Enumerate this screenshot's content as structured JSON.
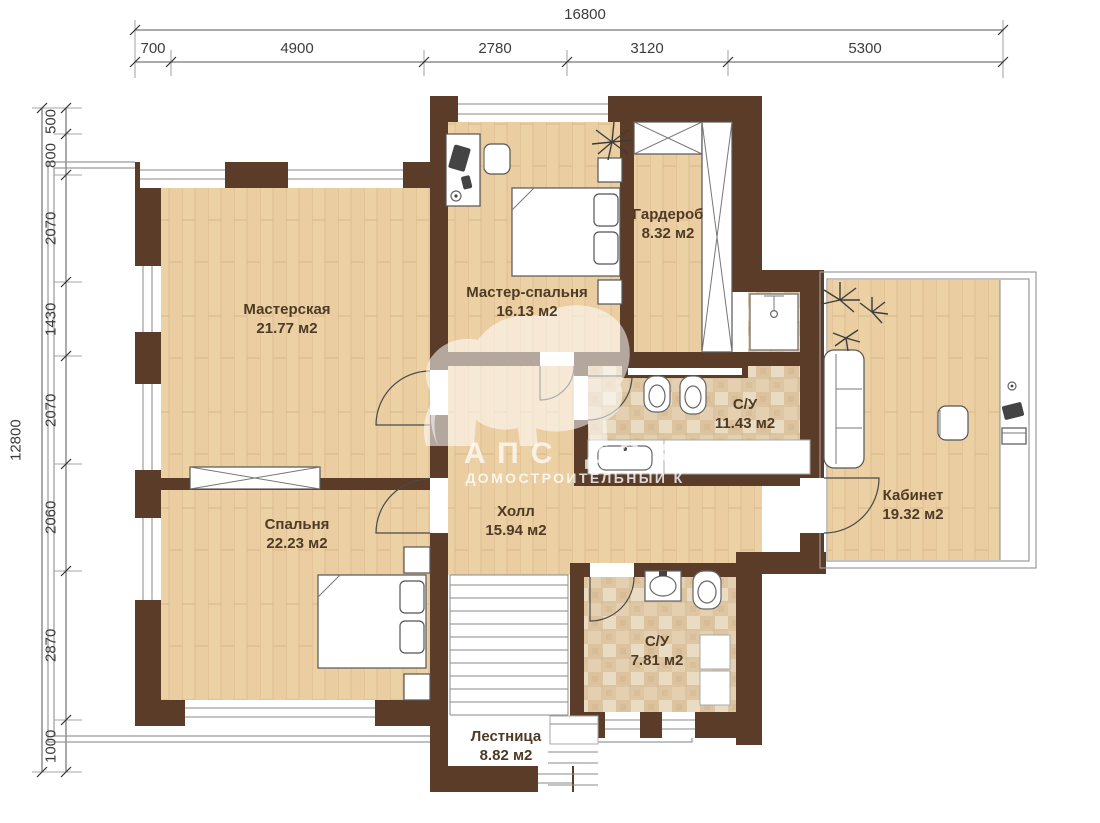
{
  "dimensions": {
    "top": {
      "total": "16800",
      "segments": [
        "700",
        "4900",
        "2780",
        "3120",
        "5300"
      ]
    },
    "left": {
      "total": "12800",
      "segments": [
        "500",
        "800",
        "2070",
        "1430",
        "2070",
        "2060",
        "2870",
        "1000"
      ]
    }
  },
  "rooms": [
    {
      "name": "Мастерская",
      "area": "21.77 м2"
    },
    {
      "name": "Мастер-спальня",
      "area": "16.13 м2"
    },
    {
      "name": "Гардероб",
      "area": "8.32 м2"
    },
    {
      "name": "С/У",
      "area": "11.43 м2"
    },
    {
      "name": "Кабинет",
      "area": "19.32 м2"
    },
    {
      "name": "Спальня",
      "area": "22.23 м2"
    },
    {
      "name": "Холл",
      "area": "15.94 м2"
    },
    {
      "name": "С/У",
      "area": "7.81 м2"
    },
    {
      "name": "Лестница",
      "area": "8.82 м2"
    }
  ],
  "watermark": {
    "brand": "АПС ДСК",
    "tagline": "ДОМОСТРОИТЕЛЬНЫЙ К"
  },
  "colors": {
    "wall": "#5a3c28",
    "wood": "#ecd1a5",
    "tile": "#e9d6b8",
    "label": "#4f3a26"
  }
}
